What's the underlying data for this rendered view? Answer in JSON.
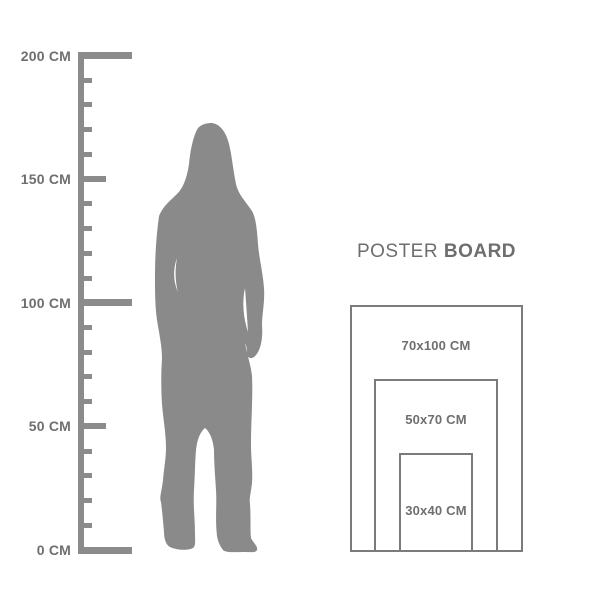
{
  "colors": {
    "background": "#ffffff",
    "ruler": "#8b8b8b",
    "silhouette": "#8a8a8a",
    "frame_border": "#7b7b7b",
    "label_text": "#6f6f6f",
    "title_text": "#6e6e6e"
  },
  "ruler": {
    "unit": "CM",
    "min_cm": 0,
    "max_cm": 200,
    "tick_step_cm": 10,
    "mid_tick_every_cm": 50,
    "major_tick_every_cm": 100,
    "labels": [
      {
        "cm": 200,
        "text": "200 CM"
      },
      {
        "cm": 150,
        "text": "150 CM"
      },
      {
        "cm": 100,
        "text": "100 CM"
      },
      {
        "cm": 50,
        "text": "50 CM"
      },
      {
        "cm": 0,
        "text": "0 CM"
      }
    ]
  },
  "figure": {
    "icon": "woman-silhouette"
  },
  "poster_board": {
    "title_regular": "POSTER",
    "title_bold": "BOARD",
    "sizes": [
      {
        "label": "70x100 CM",
        "width_cm": 70,
        "height_cm": 100
      },
      {
        "label": "50x70 CM",
        "width_cm": 50,
        "height_cm": 70
      },
      {
        "label": "30x40 CM",
        "width_cm": 30,
        "height_cm": 40
      }
    ]
  }
}
